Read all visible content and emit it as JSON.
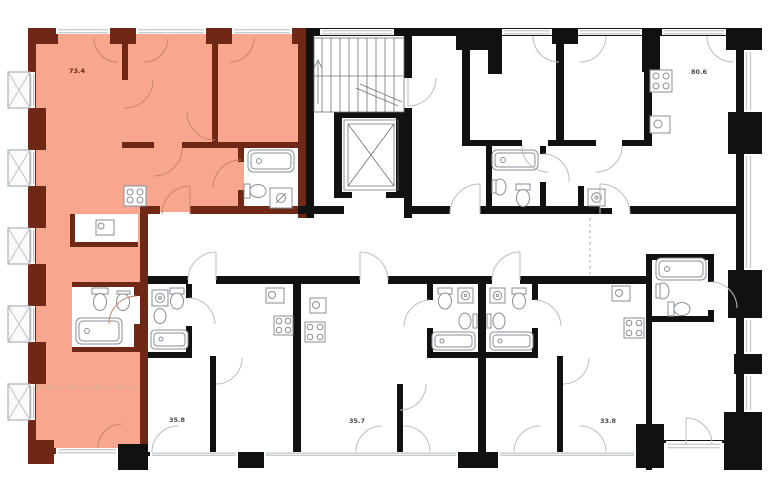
{
  "plan": {
    "type": "residential-floor-plan",
    "selected_apartment": "73.4"
  },
  "colors": {
    "selected_fill": "#f8a78e",
    "selected_wall": "#6f2816",
    "wall": "#111111",
    "window_line": "#c6cbd0",
    "arc_line": "#b7bdc2",
    "fixture_line": "#878e95",
    "label": "#4a4a4a",
    "background": "#ffffff"
  },
  "apartments": [
    {
      "id": "apt-73-4",
      "area": "73.4",
      "selected": true
    },
    {
      "id": "apt-80-6",
      "area": "80.6",
      "selected": false
    },
    {
      "id": "apt-35-8",
      "area": "35.8",
      "selected": false
    },
    {
      "id": "apt-35-7",
      "area": "35.7",
      "selected": false
    },
    {
      "id": "apt-33-8",
      "area": "33.8",
      "selected": false
    }
  ],
  "icons": [
    "stairs-icon",
    "elevator-icon",
    "bathtub-icon",
    "toilet-icon",
    "sink-icon",
    "kitchen-sink-icon",
    "stove-icon",
    "washing-machine-icon",
    "shower-tray-icon",
    "structural-column-icon",
    "door-arc-icon",
    "window-casement-arc-icon"
  ]
}
